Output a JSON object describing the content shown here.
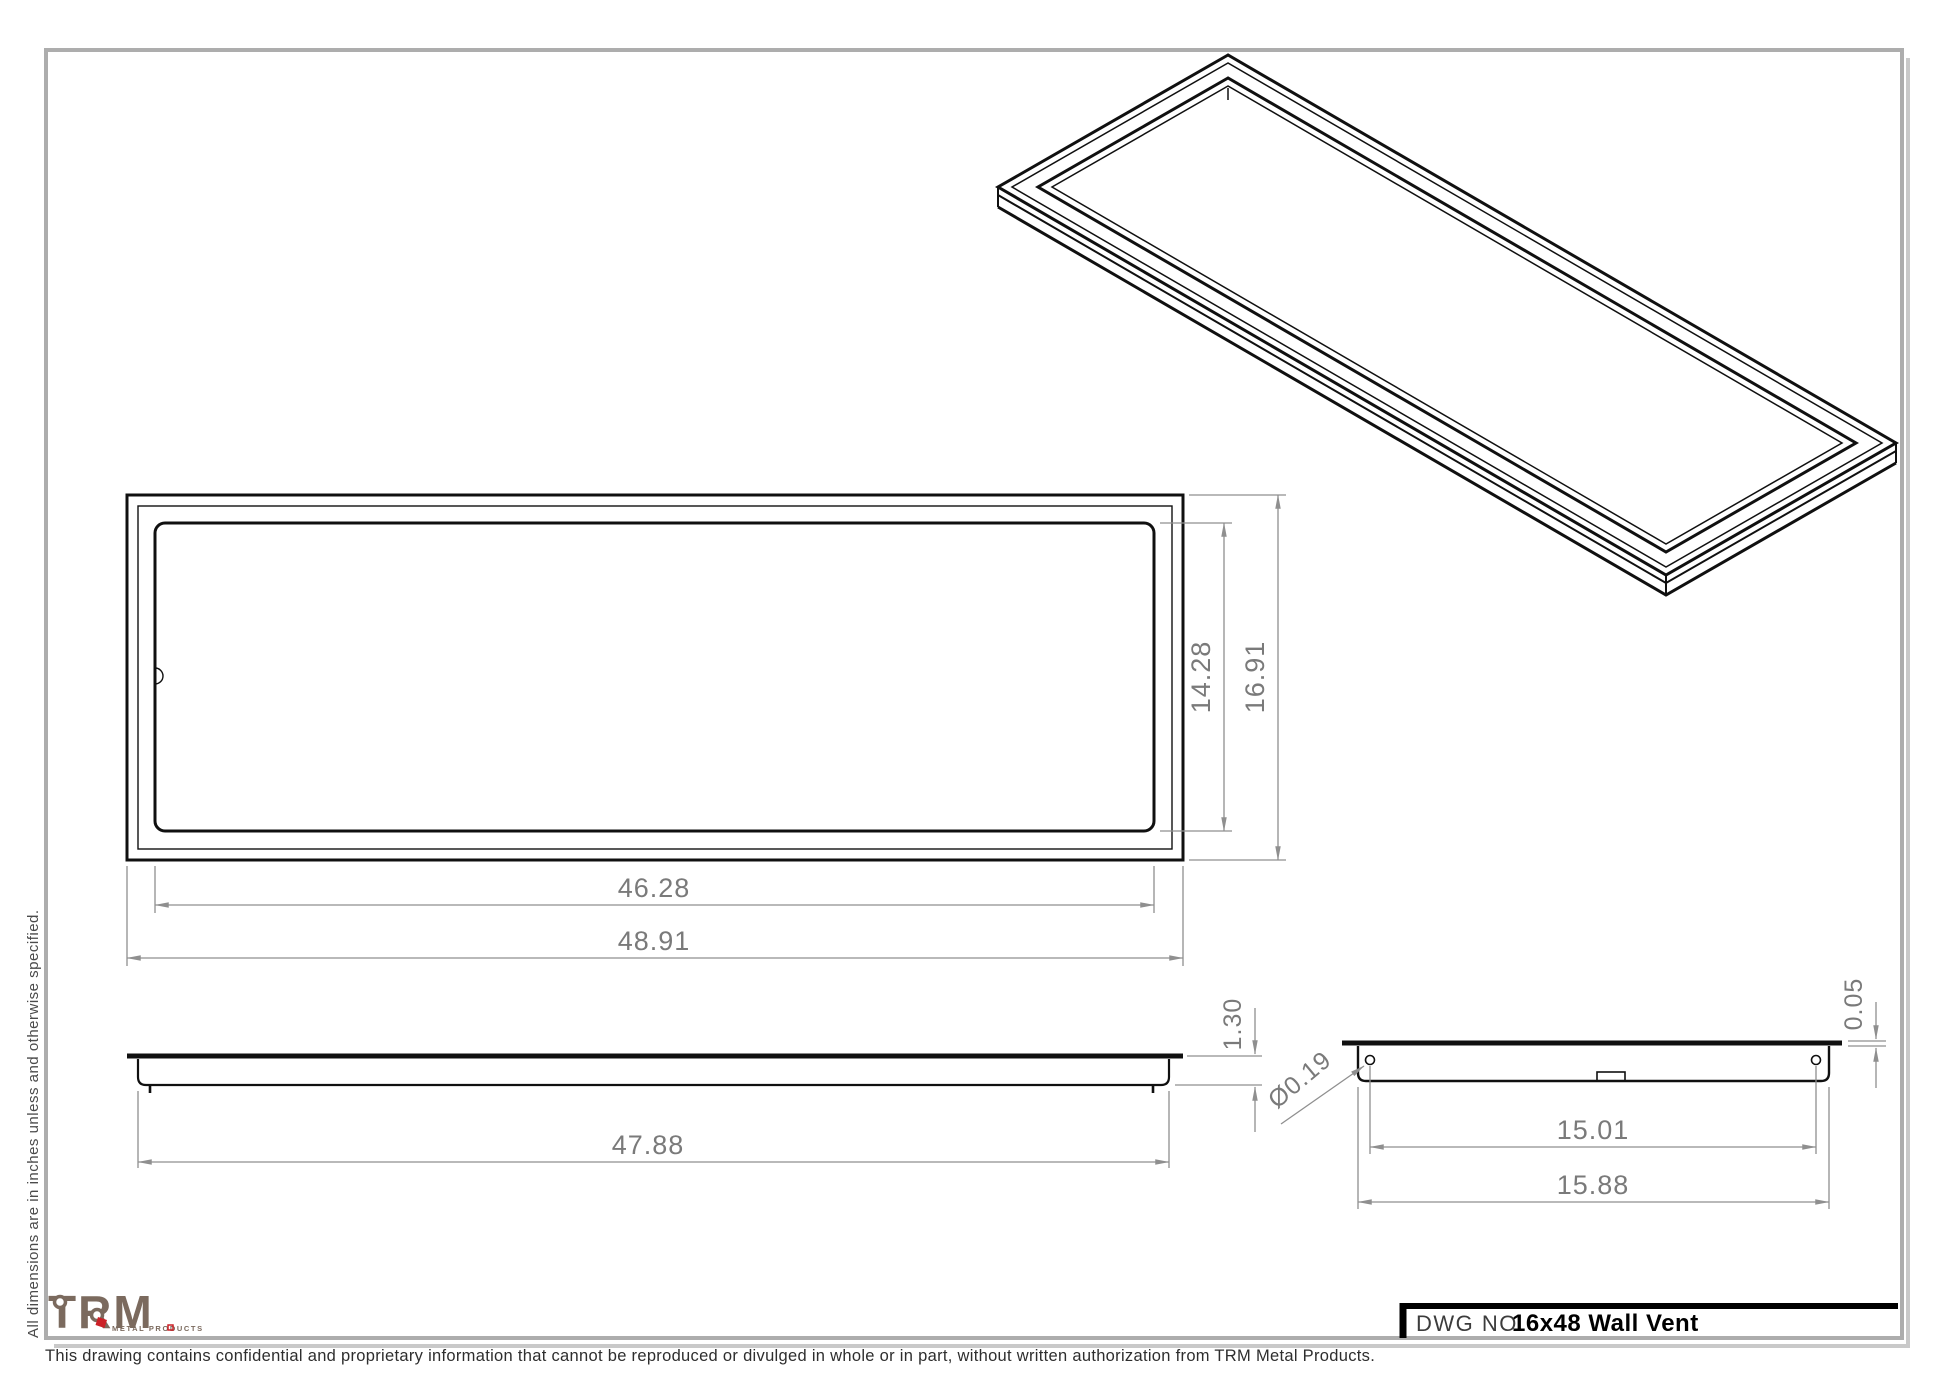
{
  "document": {
    "type": "engineering-drawing",
    "title_block": {
      "dwg_label": "DWG NO.",
      "dwg_title": "16x48 Wall Vent"
    },
    "notes": {
      "units_note": "All dimensions are in inches unless and otherwise specified.",
      "confidential_note": "This drawing contains confidential and proprietary information that cannot be reproduced or divulged in whole or in part, without written authorization from TRM Metal Products."
    },
    "logo": {
      "name": "TRM",
      "tagline": "METAL PRODUCTS"
    }
  },
  "views": {
    "front": {
      "dim_inner_width": "46.28",
      "dim_outer_width": "48.91",
      "dim_inner_height": "14.28",
      "dim_outer_height": "16.91"
    },
    "side": {
      "dim_body_length": "47.88",
      "dim_depth": "1.30"
    },
    "end": {
      "dim_hole_spacing": "15.01",
      "dim_body_width": "15.88",
      "dim_flange_thickness": "0.05",
      "dim_hole_diameter": "Ø0.19"
    }
  },
  "colors": {
    "part_edge": "#101010",
    "dimension_gray": "#8f8f8f",
    "border_gray": "#adadad",
    "shadow_gray": "#c9c9c9",
    "logo_brown": "#7b6a5e",
    "logo_red": "#cc2127"
  }
}
